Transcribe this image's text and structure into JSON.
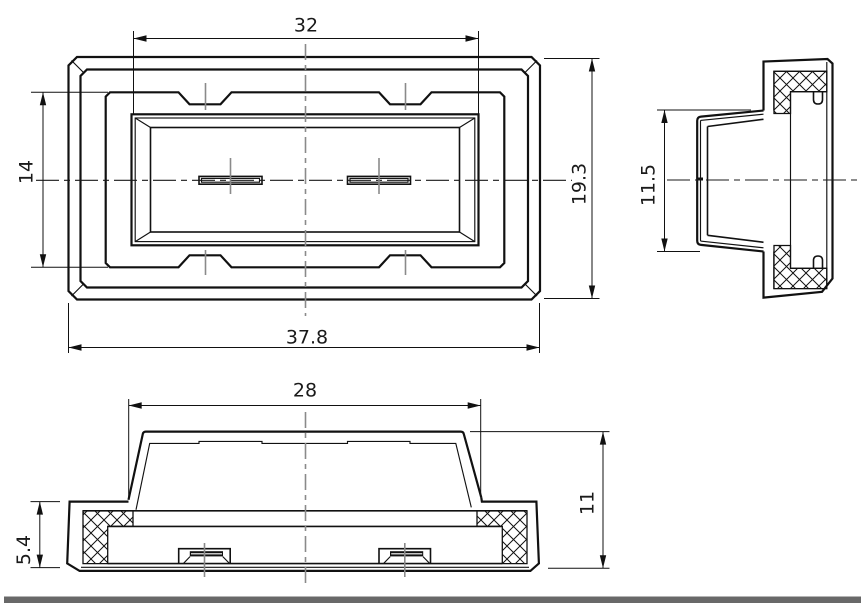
{
  "drawing": {
    "type": "technical-drawing-3-views",
    "views": {
      "front": {
        "dims": {
          "window_width": "32",
          "inner_height": "14",
          "outer_height": "19.3",
          "outer_width": "37.8"
        }
      },
      "side": {
        "dims": {
          "lens_height": "11.5"
        }
      },
      "bottom": {
        "dims": {
          "lens_width": "28",
          "base_height": "5.4",
          "total_height": "11"
        }
      }
    },
    "colors": {
      "line": "#111111",
      "centerline": "#8a8a8a",
      "bottom_bar": "#686868",
      "background": "#ffffff"
    }
  }
}
